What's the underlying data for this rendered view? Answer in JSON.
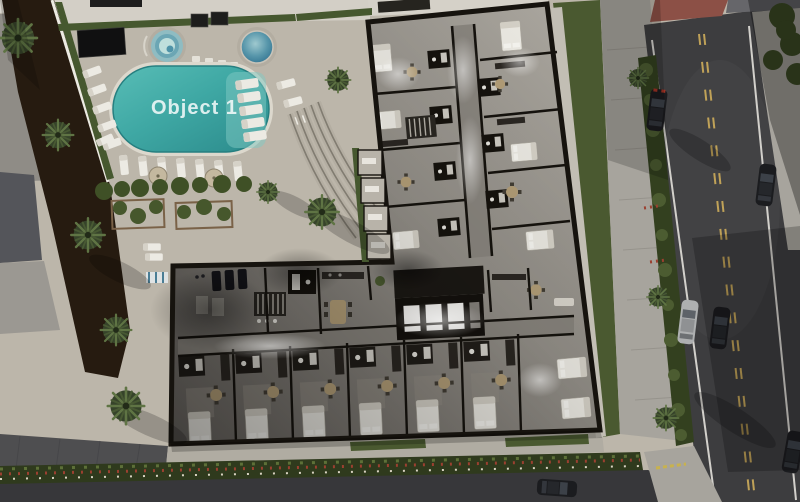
{
  "pool": {
    "label": "Object 1"
  },
  "palette": {
    "pool_water": "#3fa8a4",
    "pool_deck": "#c8c2b6",
    "plaza": "#bcb6aa",
    "building_wall": "#16130e",
    "building_floor": "#8e8a83",
    "bed_white": "#edebe4",
    "lawn": "#4a5930",
    "hedge": "#46582f",
    "soil": "#261b10",
    "palm_frond": "#5c7040",
    "road_asphalt": "#3d3d3f",
    "lane_yellow": "#c0a258",
    "lane_white": "#d2d0cb",
    "sidewalk": "#a7a49d",
    "pavers_red": "#8c5046",
    "flower_red": "#9c4030",
    "flower_white": "#d9d3c2",
    "car_dark": "#1b1c1f",
    "car_silver": "#aeb0b1",
    "spa_water": "#5796aa",
    "elevator_glow": "#f5f4f1"
  },
  "scene": {
    "building": {
      "kind": "residential cutaway floor plan",
      "elevators": 3,
      "wings": 2
    },
    "amenities": [
      "swimming pool",
      "spa pools",
      "sun loungers",
      "gym",
      "pergola garden",
      "curved steps"
    ],
    "street": {
      "cars_visible": 6
    }
  }
}
